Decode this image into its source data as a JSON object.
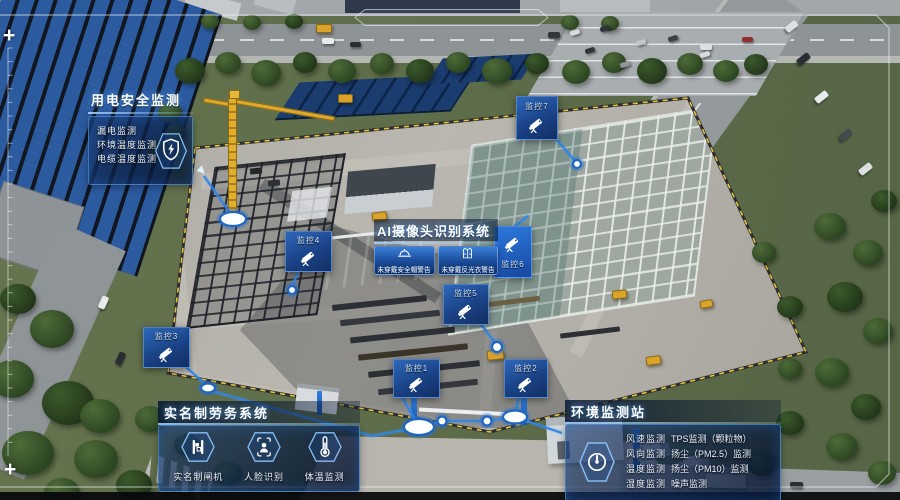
{
  "hud": {
    "corner_mark_top": "+",
    "corner_mark_bottom": "+",
    "accent_color": "#2f86e0",
    "panel_background": "rgba(6,19,44,0.85)"
  },
  "panels": {
    "electric_safety": {
      "title": "用电安全监测",
      "icon": "shield-lightning-icon",
      "items": [
        "漏电监测",
        "环境温度监测",
        "电缆温度监测"
      ]
    },
    "ai_camera": {
      "title": "AI摄像头识别系统",
      "warnings": [
        {
          "icon": "helmet-icon",
          "label": "未穿戴安全帽警告"
        },
        {
          "icon": "vest-icon",
          "label": "未穿戴反光衣警告"
        }
      ]
    },
    "labor_system": {
      "title": "实名制劳务系统",
      "items": [
        {
          "icon": "turnstile-icon",
          "label": "实名制闸机"
        },
        {
          "icon": "face-recognition-icon",
          "label": "人脸识别"
        },
        {
          "icon": "thermometer-icon",
          "label": "体温监测"
        }
      ]
    },
    "environment_station": {
      "title": "环境监测站",
      "icon": "gauge-icon",
      "items_col1": [
        "风速监测",
        "风向监测",
        "温度监测",
        "湿度监测"
      ],
      "items_col2": [
        "TPS监测（颗粒物）",
        "扬尘（PM2.5）监测",
        "扬尘（PM10）监测",
        "噪声监测"
      ]
    }
  },
  "camera_markers": [
    {
      "label": "监控1",
      "icon": "cctv-camera-icon"
    },
    {
      "label": "监控2",
      "icon": "cctv-camera-icon"
    },
    {
      "label": "监控3",
      "icon": "cctv-camera-icon"
    },
    {
      "label": "监控4",
      "icon": "cctv-camera-icon"
    },
    {
      "label": "监控5",
      "icon": "cctv-camera-icon"
    },
    {
      "label": "监控6",
      "icon": "cctv-camera-icon"
    },
    {
      "label": "监控7",
      "icon": "cctv-camera-icon"
    }
  ]
}
